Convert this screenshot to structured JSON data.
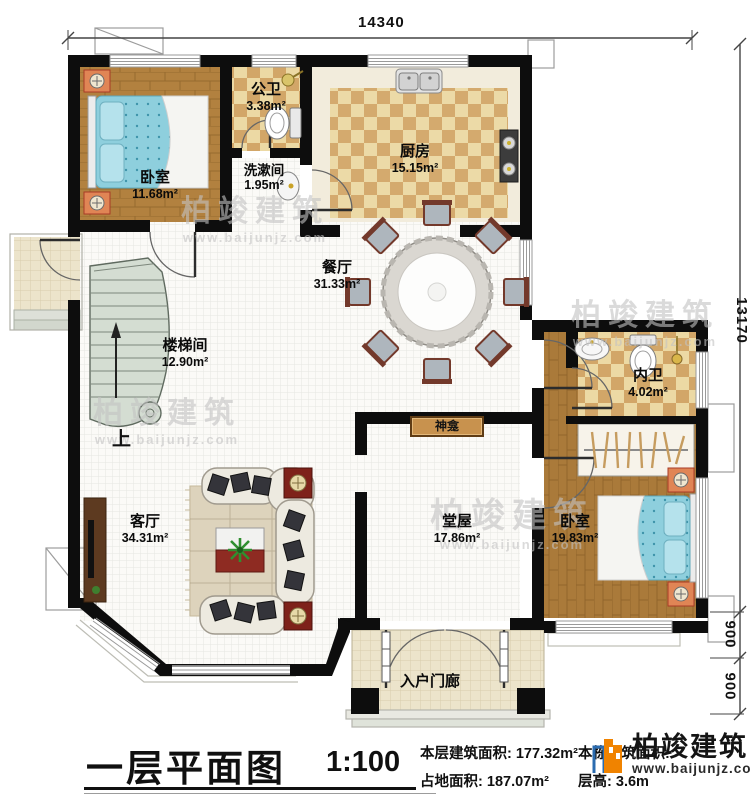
{
  "plan": {
    "rooms": [
      {
        "id": "bedroom-1",
        "name": "卧室",
        "area": "11.68m²"
      },
      {
        "id": "public-bath",
        "name": "公卫",
        "area": "3.38m²"
      },
      {
        "id": "washroom",
        "name": "洗漱间",
        "area": "1.95m²"
      },
      {
        "id": "kitchen",
        "name": "厨房",
        "area": "15.15m²"
      },
      {
        "id": "dining",
        "name": "餐厅",
        "area": "31.33m²"
      },
      {
        "id": "stairwell",
        "name": "楼梯间",
        "area": "12.90m²"
      },
      {
        "id": "inner-bath",
        "name": "内卫",
        "area": "4.02m²"
      },
      {
        "id": "shrine",
        "name": "神龛",
        "area": ""
      },
      {
        "id": "living",
        "name": "客厅",
        "area": "34.31m²"
      },
      {
        "id": "hall",
        "name": "堂屋",
        "area": "17.86m²"
      },
      {
        "id": "bedroom-2",
        "name": "卧室",
        "area": "19.83m²"
      },
      {
        "id": "entry-porch",
        "name": "入户门廊",
        "area": ""
      }
    ],
    "stair_up_label": "上"
  },
  "dimensions": {
    "top_width": "14340",
    "right_height": "13170",
    "porch_depth": "900",
    "step_depth": "900"
  },
  "watermark": {
    "brand": "柏竣建筑",
    "site": "www.baijunjz.com"
  },
  "title_block": {
    "title": "一层平面图",
    "scale": "1:100",
    "floor_area_label": "本层建筑面积:",
    "floor_area_value": "177.32m²",
    "land_area_label": "占地面积:",
    "land_area_value": "187.07m²",
    "total_area_label": "本栋建筑面积:",
    "height_label": "层高:",
    "height_value": "3.6m"
  },
  "logo": {
    "brand": "柏竣建筑",
    "site": "www.baijunjz.com"
  },
  "colors": {
    "wall": "#0d0d0d",
    "wood_floor": "#b2813f",
    "tile_accent": "#d2a668",
    "bed_blue": "#8ecfdd",
    "logo_orange": "#f08300",
    "logo_blue": "#2b6cb0"
  }
}
